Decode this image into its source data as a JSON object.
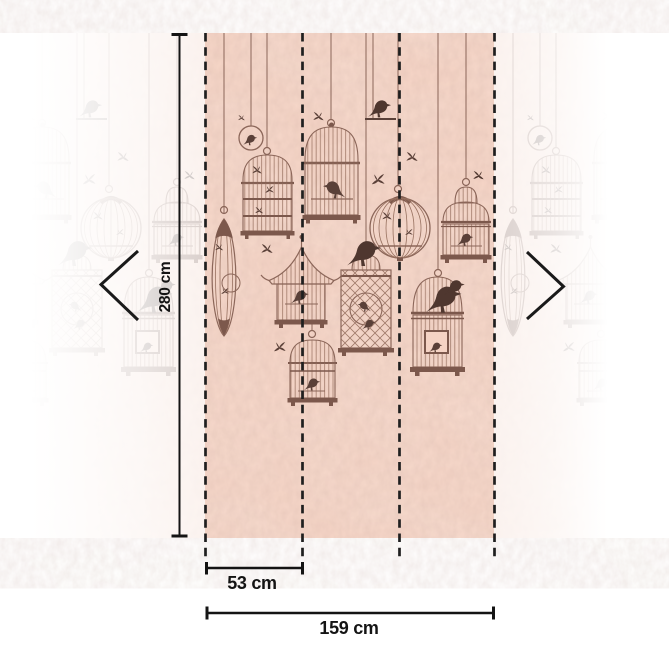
{
  "measurements": {
    "height": "280 cm",
    "panel_width": "53 cm",
    "total_width": "159 cm"
  },
  "wallpaper": {
    "motif": "hanging birdcages with birds",
    "panel_count": 3,
    "base_color": "#f5d3c4",
    "outline_color": "#8b6659",
    "silhouette_color": "#5a4038",
    "solid_color": "#7c584c"
  },
  "annotations": {
    "color": "#141414"
  },
  "nav": {
    "prev_icon": "chevron-left",
    "next_icon": "chevron-right"
  }
}
